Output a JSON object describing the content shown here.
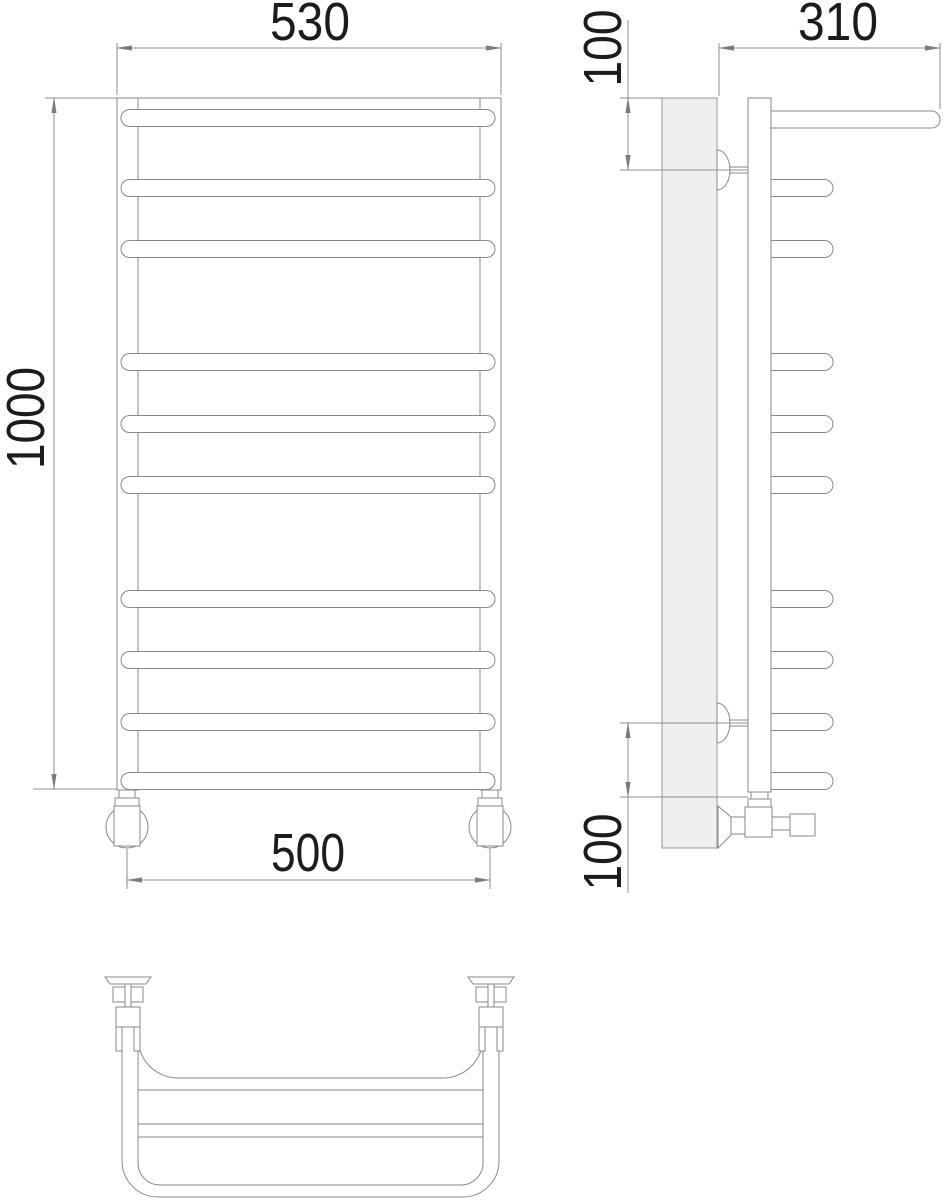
{
  "drawing": {
    "type": "towel-rail-technical-drawing",
    "colors": {
      "line": "#8a8a8a",
      "text": "#1c1c1c",
      "wall_fill": "#efefef"
    },
    "dimensions": {
      "front_width_top": "530",
      "front_height": "1000",
      "front_width_bottom": "500",
      "side_depth": "310",
      "side_top_offset": "100",
      "side_bottom_offset": "100"
    }
  }
}
